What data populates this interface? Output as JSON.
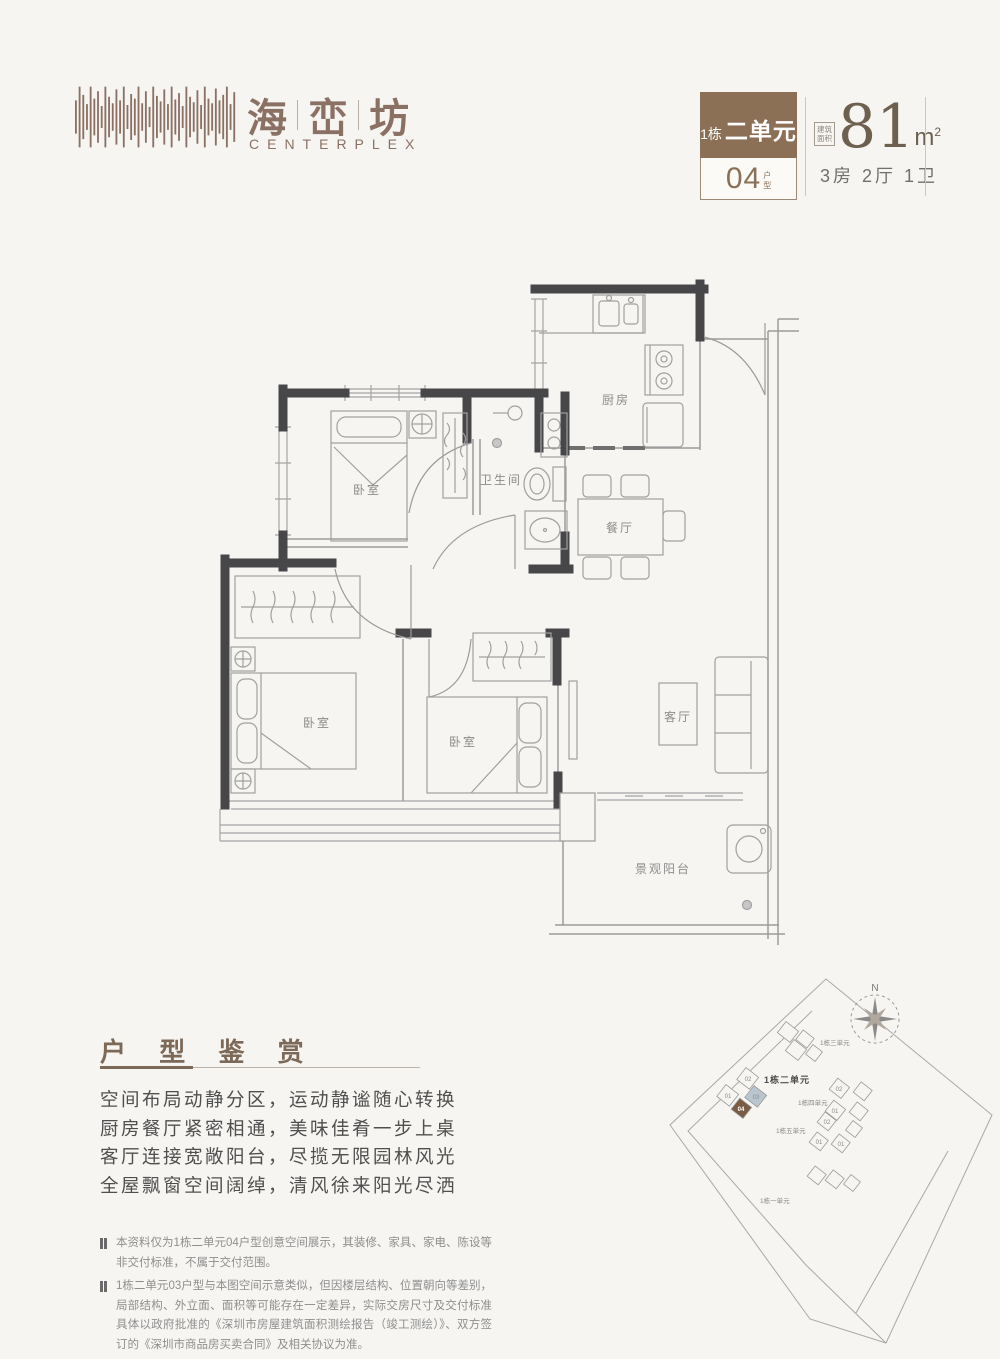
{
  "brand": {
    "cn_char_1": "海",
    "cn_char_2": "峦",
    "cn_char_3": "坊",
    "en": "CENTERPLEX"
  },
  "badge": {
    "building": "1栋",
    "unit": "二单元",
    "type_number": "04",
    "type_suffix_1": "户",
    "type_suffix_2": "型"
  },
  "spec": {
    "area_label_1": "建筑",
    "area_label_2": "面积",
    "area_value": "81",
    "area_unit": "m",
    "area_sup": "2",
    "rooms": "3房 2厅 1卫"
  },
  "floorplan": {
    "kitchen": "厨房",
    "bathroom": "卫生间",
    "dining": "餐厅",
    "bedroom": "卧室",
    "living": "客厅",
    "balcony": "景观阳台"
  },
  "appreciation": {
    "title": "户 型 鉴 赏",
    "lines": [
      "空间布局动静分区，运动静谧随心转换",
      "厨房餐厅紧密相通，美味佳肴一步上桌",
      "客厅连接宽敞阳台，尽揽无限园林风光",
      "全屋飘窗空间阔绰，清风徐来阳光尽洒"
    ]
  },
  "notes": [
    "本资料仅为1栋二单元04户型创意空间展示，其装修、家具、家电、陈设等非交付标准，不属于交付范围。",
    "1栋二单元03户型与本图空间示意类似，但因楼层结构、位置朝向等差别，局部结构、外立面、面积等可能存在一定差异，实际交房尺寸及交付标准具体以政府批准的《深圳市房屋建筑面积测绘报告（竣工测绘）》、双方签订的《深圳市商品房买卖合同》及相关协议为准。"
  ],
  "sitemap": {
    "north": "N",
    "unit1": "1栋一单元",
    "unit2": "1栋二单元",
    "unit3": "1栋三单元",
    "unit4": "1栋四单元",
    "unit5": "1栋五单元",
    "box01": "01",
    "box02": "02",
    "box03": "03",
    "box04": "04",
    "highlight_color": "#7a5c44",
    "secondary_color": "#b9c6cf"
  }
}
